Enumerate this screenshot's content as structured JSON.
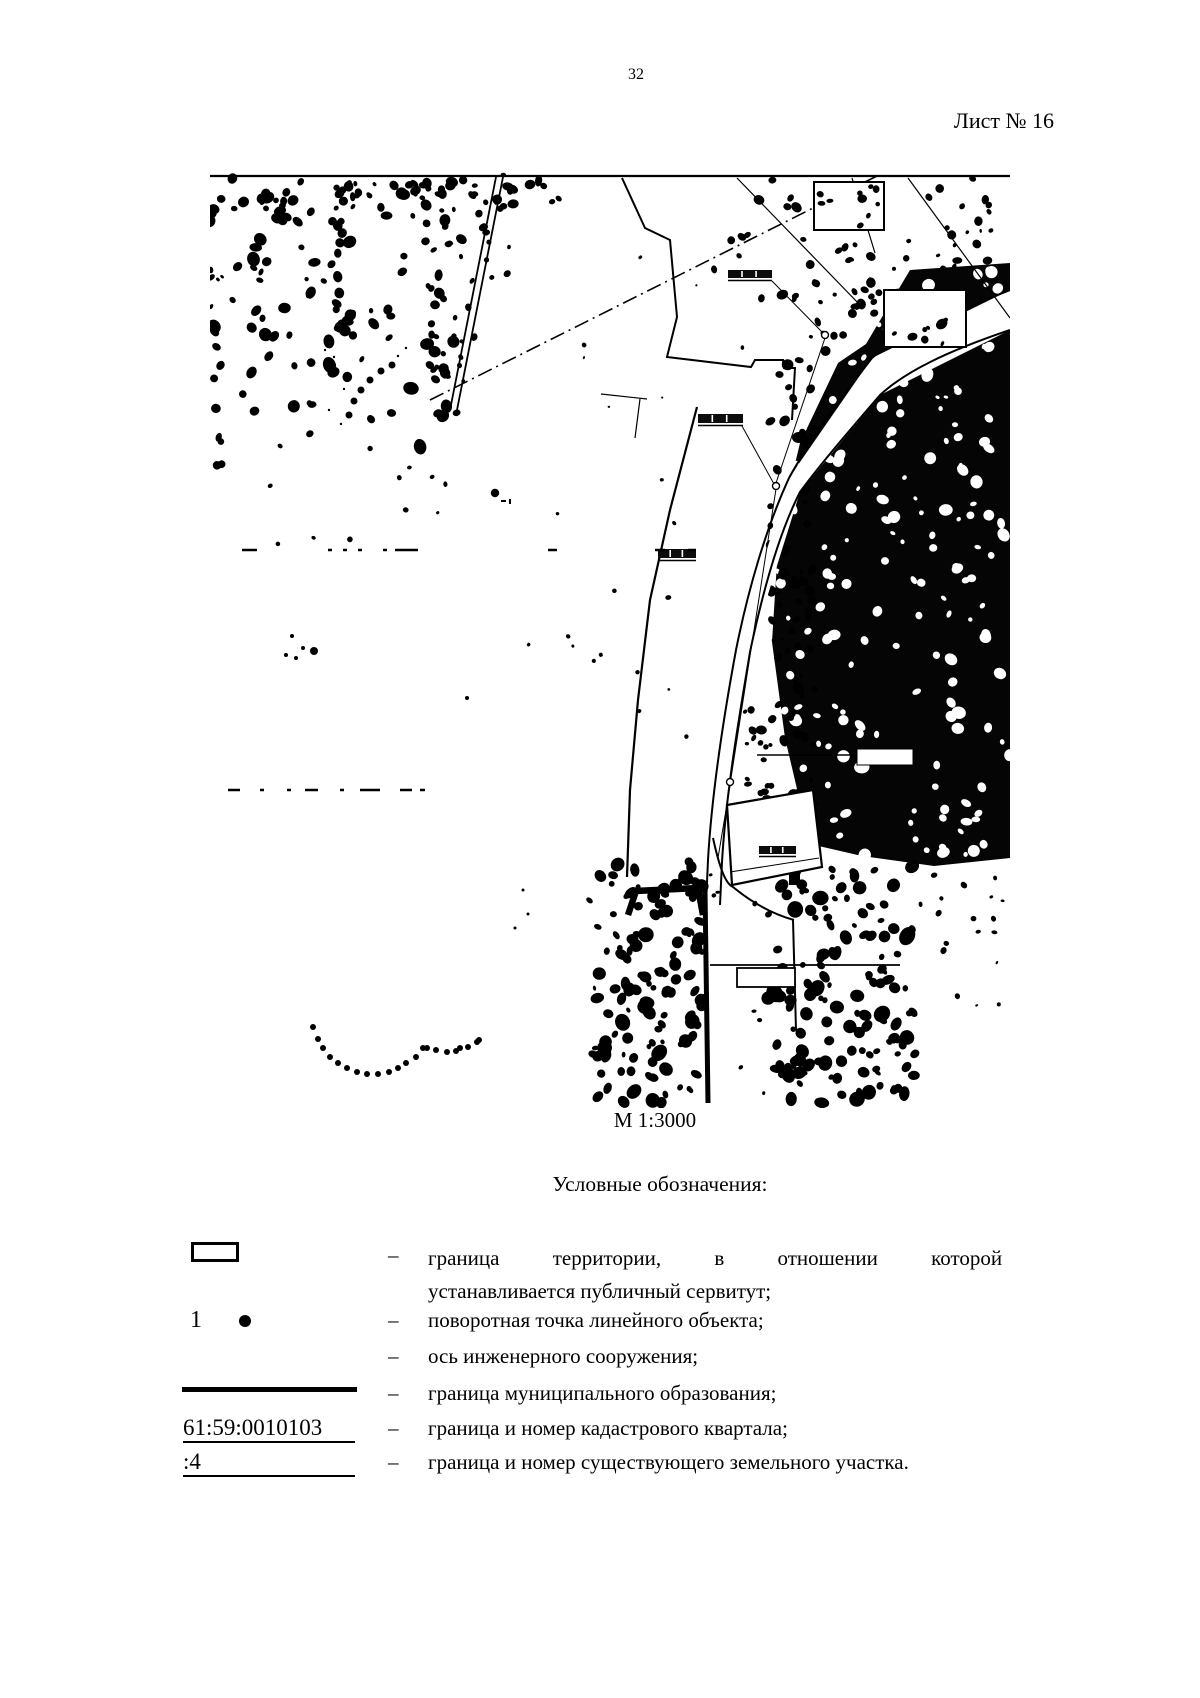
{
  "page": {
    "number": "32",
    "sheet_label": "Лист № 16"
  },
  "map": {
    "scale_label": "М 1:3000"
  },
  "legend": {
    "title": "Условные обозначения:",
    "dash": "–",
    "items": [
      {
        "name": "servitude-territory-boundary",
        "symbol": "rectangle-outline",
        "text": "граница территории, в отношении которой устанавливается публичный сервитут;",
        "text_lines": [
          "граница территории, в отношении которой",
          "устанавливается публичный сервитут;"
        ]
      },
      {
        "name": "turning-point",
        "symbol": "numbered-dot",
        "number": "1",
        "text": "поворотная точка линейного объекта;"
      },
      {
        "name": "engineering-axis",
        "symbol": "none",
        "text": "ось инженерного сооружения;"
      },
      {
        "name": "municipal-boundary",
        "symbol": "thick-line",
        "text": "граница муниципального образования;"
      },
      {
        "name": "cadastral-quarter",
        "symbol": "underlined-number",
        "number": "61:59:0010103",
        "text": "граница и номер кадастрового квартала;"
      },
      {
        "name": "existing-parcel",
        "symbol": "underlined-number",
        "number": ":4",
        "text": "граница и номер существующего земельного участка."
      }
    ]
  }
}
